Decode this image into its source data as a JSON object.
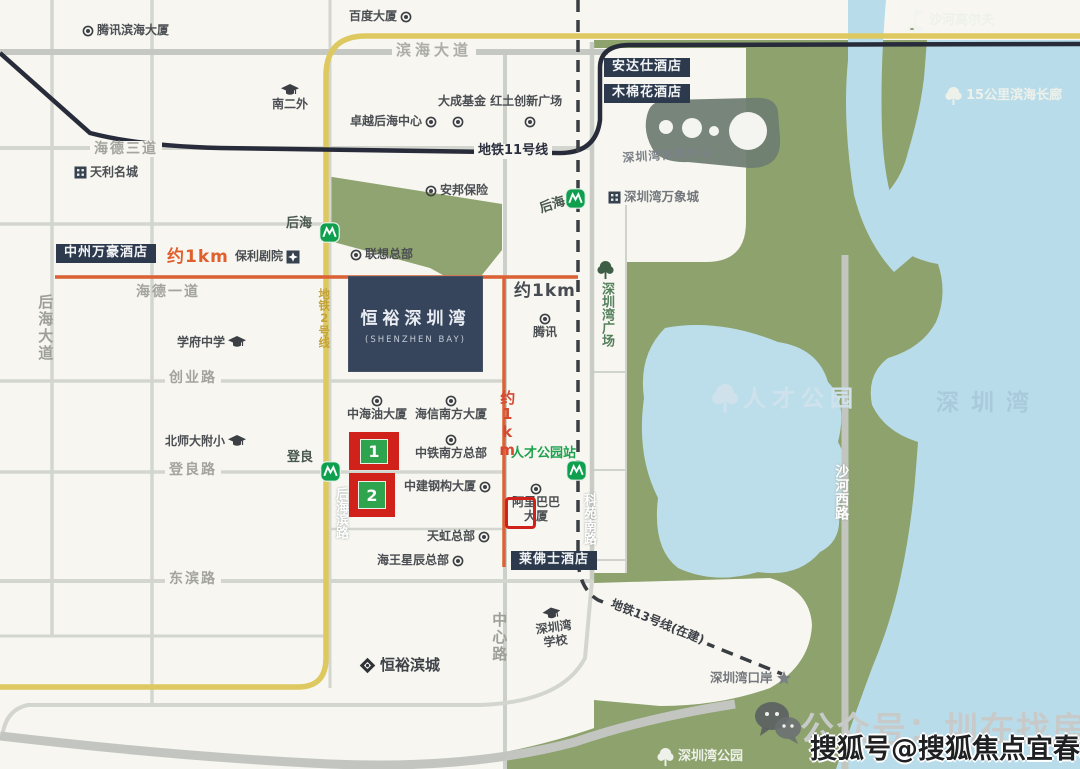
{
  "page": {
    "width": 1080,
    "height": 769
  },
  "colors": {
    "land": "#f7f6f1",
    "park_green": "#8da26c",
    "water_blue": "#b9dcea",
    "metro2_yellow": "#ddc95f",
    "metro11_dark": "#282b3a",
    "metro13_dashed": "#3a3e43",
    "radius_orange": "#dc6236",
    "marker_red": "#d0221b",
    "marker_green": "#2ea44f",
    "darkbox_navy": "#2d3a4d",
    "project_navy": "#36455b",
    "station_green": "#0fa04f"
  },
  "project_box": {
    "name_cn": "恒裕深圳湾",
    "name_en": "(SHENZHEN BAY)"
  },
  "project_highlight": {
    "text": "后海沄玺花园"
  },
  "markers": [
    {
      "label": "1"
    },
    {
      "label": "2"
    }
  ],
  "watermark": {
    "light": "公众号：圳在找房",
    "dark": "搜狐号@搜狐焦点宜春站"
  },
  "labels": [
    {
      "name": "tencent-binhai-tower",
      "text": "腾讯滨海大厦",
      "x": 82,
      "y": 24,
      "cls": "poi",
      "icon": "dot"
    },
    {
      "name": "baidu-tower",
      "text": "百度大厦",
      "x": 349,
      "y": 10,
      "cls": "poi",
      "icon": "dot",
      "ipos": "right"
    },
    {
      "name": "binhai-avenue-label",
      "text": "滨海大道",
      "x": 392,
      "y": 42,
      "cls": "road-lg bgmask"
    },
    {
      "name": "nanerwai-school",
      "text": "南二外",
      "x": 272,
      "y": 84,
      "cls": "poi ip-above",
      "icon": "cap",
      "ipos": "above"
    },
    {
      "name": "zhuoyue-houhai-center",
      "text": "卓越后海中心",
      "x": 350,
      "y": 115,
      "cls": "poi",
      "icon": "dot",
      "ipos": "right"
    },
    {
      "name": "dacheng-fund-hongtu-plaza",
      "text": "大成基金 红土创新广场",
      "x": 438,
      "y": 95,
      "cls": "poi"
    },
    {
      "name": "poi-dot-dacheng",
      "text": "",
      "x": 452,
      "y": 116,
      "cls": "",
      "icon": "dot"
    },
    {
      "name": "poi-dot-hongtu",
      "text": "",
      "x": 524,
      "y": 116,
      "cls": "",
      "icon": "dot"
    },
    {
      "name": "metro-line11-label",
      "text": "地铁11号线",
      "x": 474,
      "y": 144,
      "cls": "metro-line-label bgmask"
    },
    {
      "name": "andaz-hotel",
      "text": "安达仕酒店",
      "x": 604,
      "y": 58,
      "cls": "darkbox"
    },
    {
      "name": "mumianhua-hotel",
      "text": "木棉花酒店",
      "x": 604,
      "y": 84,
      "cls": "darkbox"
    },
    {
      "name": "shahe-golf",
      "text": "沙河高尔夫",
      "x": 904,
      "y": 8,
      "cls": "on-green",
      "icon": "golf"
    },
    {
      "name": "sports-center-label",
      "text": "深圳湾体育中心",
      "x": 622,
      "y": 152,
      "cls": "gray-it",
      "rot": -4
    },
    {
      "name": "mixc-label",
      "text": "深圳湾万象城",
      "x": 608,
      "y": 190,
      "cls": "gray-md",
      "icon": "bldg"
    },
    {
      "name": "haide-3rd-road",
      "text": "海德三道",
      "x": 90,
      "y": 141,
      "cls": "road bgmask"
    },
    {
      "name": "tianli-mingcheng",
      "text": "天利名城",
      "x": 74,
      "y": 166,
      "cls": "poi",
      "icon": "bldg"
    },
    {
      "name": "houhai-station-line2",
      "text": "后海",
      "x": 286,
      "y": 217,
      "cls": "station"
    },
    {
      "name": "metro-icon-houhai-l2",
      "text": "",
      "x": 319,
      "y": 222,
      "cls": "",
      "icon": "metro"
    },
    {
      "name": "houhai-station-line11",
      "text": "后海",
      "x": 538,
      "y": 203,
      "cls": "station",
      "rot": -18
    },
    {
      "name": "metro-icon-houhai-l11",
      "text": "",
      "x": 565,
      "y": 188,
      "cls": "",
      "icon": "metro"
    },
    {
      "name": "coastal-corridor-15km",
      "text": "15公里滨海长廊",
      "x": 944,
      "y": 86,
      "cls": "on-green",
      "icon": "treew"
    },
    {
      "name": "zhongzhou-marriott-hotel",
      "text": "中州万豪酒店",
      "x": 56,
      "y": 244,
      "cls": "darkbox"
    },
    {
      "name": "approx-1km-west",
      "text": "约1km",
      "x": 167,
      "y": 248,
      "cls": "km-orange"
    },
    {
      "name": "poly-theatre",
      "text": "保利剧院",
      "x": 235,
      "y": 250,
      "cls": "poi",
      "icon": "starbox",
      "ipos": "right"
    },
    {
      "name": "haide-1st-road",
      "text": "海德一道",
      "x": 136,
      "y": 284,
      "cls": "road"
    },
    {
      "name": "approx-1km-east",
      "text": "约1km",
      "x": 514,
      "y": 282,
      "cls": "km-dark"
    },
    {
      "name": "szbay-plaza",
      "text": "深圳湾广场",
      "x": 596,
      "y": 260,
      "cls": "v-green vert ip-above",
      "icon": "treeg",
      "ipos": "above"
    },
    {
      "name": "lenovo-hq",
      "text": "联想总部",
      "x": 350,
      "y": 248,
      "cls": "poi",
      "icon": "dot"
    },
    {
      "name": "anbang-insurance",
      "text": "安邦保险",
      "x": 425,
      "y": 184,
      "cls": "poi",
      "icon": "dot"
    },
    {
      "name": "tencent-hq",
      "text": "腾讯",
      "x": 533,
      "y": 313,
      "cls": "poi ip-above",
      "icon": "dot",
      "ipos": "above"
    },
    {
      "name": "xuefu-middle-school",
      "text": "学府中学",
      "x": 177,
      "y": 336,
      "cls": "poi",
      "icon": "cap",
      "ipos": "right"
    },
    {
      "name": "chuangye-road",
      "text": "创业路",
      "x": 165,
      "y": 370,
      "cls": "road bgmask"
    },
    {
      "name": "houhai-avenue",
      "text": "后海大道",
      "x": 36,
      "y": 294,
      "cls": "road-v vert"
    },
    {
      "name": "talent-park",
      "text": "人才公园",
      "x": 710,
      "y": 382,
      "cls": "park-lg",
      "icon": "treewlg"
    },
    {
      "name": "shenzhen-bay-name",
      "text": "深圳湾",
      "x": 936,
      "y": 390,
      "cls": "bay-name"
    },
    {
      "name": "zhonghaiyou-tower",
      "text": "中海油大厦",
      "x": 347,
      "y": 395,
      "cls": "poi ip-above",
      "icon": "dot",
      "ipos": "above"
    },
    {
      "name": "haixin-south-tower",
      "text": "海信南方大厦",
      "x": 415,
      "y": 395,
      "cls": "poi ip-above",
      "icon": "dot",
      "ipos": "above"
    },
    {
      "name": "bsd-primary-school",
      "text": "北师大附小",
      "x": 165,
      "y": 435,
      "cls": "poi",
      "icon": "cap",
      "ipos": "right"
    },
    {
      "name": "dengliang-road",
      "text": "登良路",
      "x": 165,
      "y": 462,
      "cls": "road bgmask"
    },
    {
      "name": "dengliang-station",
      "text": "登良",
      "x": 287,
      "y": 451,
      "cls": "station"
    },
    {
      "name": "metro-icon-dengliang",
      "text": "",
      "x": 320,
      "y": 461,
      "cls": "",
      "icon": "metro"
    },
    {
      "name": "zhongtie-south-hq",
      "text": "中铁南方总部",
      "x": 415,
      "y": 434,
      "cls": "poi ip-above",
      "icon": "dot",
      "ipos": "above"
    },
    {
      "name": "talent-park-station",
      "text": "人才公园站",
      "x": 511,
      "y": 447,
      "cls": "station-green"
    },
    {
      "name": "metro-icon-talent-park",
      "text": "",
      "x": 566,
      "y": 460,
      "cls": "",
      "icon": "metro"
    },
    {
      "name": "approx-1km-south",
      "text": "约1km",
      "x": 498,
      "y": 390,
      "cls": "km-red-v vert"
    },
    {
      "name": "zhongjian-steel-tower",
      "text": "中建钢构大厦",
      "x": 404,
      "y": 480,
      "cls": "poi",
      "icon": "dot",
      "ipos": "right"
    },
    {
      "name": "alibaba-tower",
      "text": "阿里巴巴\n大厦",
      "x": 512,
      "y": 483,
      "cls": "poi multi ip-above",
      "icon": "dot",
      "ipos": "above"
    },
    {
      "name": "keyuan-south-road",
      "text": "科苑南路",
      "x": 580,
      "y": 493,
      "cls": "road-white-v vert"
    },
    {
      "name": "houhaibin-road",
      "text": "后海滨路",
      "x": 332,
      "y": 487,
      "cls": "road-white-v vert"
    },
    {
      "name": "tianhong-hq",
      "text": "天虹总部",
      "x": 427,
      "y": 530,
      "cls": "poi",
      "icon": "dot",
      "ipos": "right"
    },
    {
      "name": "raffles-hotel",
      "text": "莱佛士酒店",
      "x": 511,
      "y": 551,
      "cls": "darkbox"
    },
    {
      "name": "neptunus-hq",
      "text": "海王星辰总部",
      "x": 377,
      "y": 554,
      "cls": "poi",
      "icon": "dot",
      "ipos": "right"
    },
    {
      "name": "dongbin-road",
      "text": "东滨路",
      "x": 165,
      "y": 571,
      "cls": "road bgmask"
    },
    {
      "name": "zhongxin-road",
      "text": "中心路",
      "x": 490,
      "y": 612,
      "cls": "road-v vert"
    },
    {
      "name": "szbay-school",
      "text": "深圳湾\n学校",
      "x": 533,
      "y": 610,
      "cls": "poi multi ip-above",
      "icon": "cap",
      "ipos": "above",
      "rot": -8
    },
    {
      "name": "metro-line13-label",
      "text": "地铁13号线(在建)",
      "x": 610,
      "y": 596,
      "cls": "metro-line-label sm bgmask",
      "rot": 22
    },
    {
      "name": "hengyu-bincheng",
      "text": "恒裕滨城",
      "x": 358,
      "y": 656,
      "cls": "poi lg",
      "icon": "diamond"
    },
    {
      "name": "szbay-port",
      "text": "深圳湾口岸",
      "x": 710,
      "y": 670,
      "cls": "gray-md",
      "icon": "star",
      "ipos": "right"
    },
    {
      "name": "szbay-park",
      "text": "深圳湾公园",
      "x": 656,
      "y": 747,
      "cls": "on-green",
      "icon": "treew"
    },
    {
      "name": "metro-line2-label",
      "text": "地铁2号线",
      "x": 317,
      "y": 288,
      "cls": "l2-label vert"
    },
    {
      "name": "shahexi-road",
      "text": "沙河西路",
      "x": 833,
      "y": 464,
      "cls": "road-white-v lg vert"
    }
  ]
}
